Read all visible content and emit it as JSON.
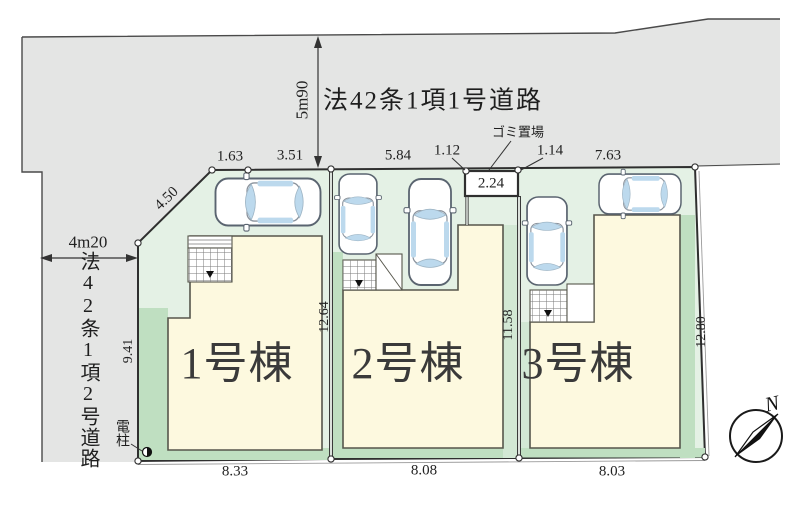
{
  "site_plan": {
    "roads": {
      "top": {
        "label": "法42条1項1号道路",
        "width": "5m90"
      },
      "left": {
        "label": "法42条1項2号道路",
        "width": "4m20"
      }
    },
    "buildings": [
      {
        "name": "1号棟"
      },
      {
        "name": "2号棟"
      },
      {
        "name": "3号棟"
      }
    ],
    "dimensions": {
      "top_edge": [
        "1.63",
        "3.51",
        "5.84",
        "1.12",
        "1.14",
        "7.63"
      ],
      "diagonal": "4.50",
      "left_edge": "9.41",
      "plot_depths": [
        "12.64",
        "11.58",
        "12.80"
      ],
      "bottom_edge": [
        "8.33",
        "8.08",
        "8.03"
      ],
      "garbage_width": "2.24"
    },
    "annotations": {
      "garbage": "ゴミ置場",
      "utility_pole": "電柱",
      "compass_north": "N"
    },
    "colors": {
      "road": "#e4e5e4",
      "plot_green": "#e4f1e5",
      "margin_green": "#bfdfc1",
      "building_cream": "#fdf9df",
      "car_glass": "#bcd9ed"
    }
  }
}
